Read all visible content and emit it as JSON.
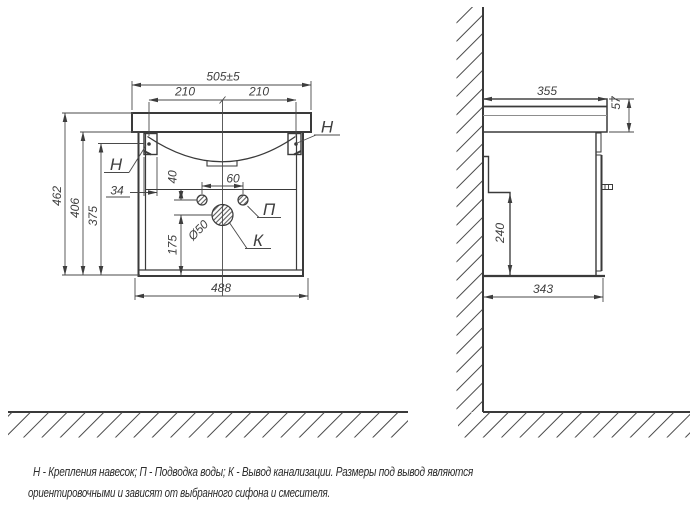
{
  "front_view": {
    "dims": {
      "top_width": "505±5",
      "hanger_span_left": "210",
      "hanger_span_right": "210",
      "height_total": "462",
      "height_body": "406",
      "height_hanger": "375",
      "hanger_offset": "34",
      "hole_drop": "40",
      "hole_span": "60",
      "drain_drop": "175",
      "drain_diameter": "Ø50",
      "bottom_width": "488"
    },
    "labels": {
      "hanger": "Н",
      "water": "П",
      "drain": "К"
    }
  },
  "side_view": {
    "dims": {
      "top_depth": "355",
      "top_height": "57",
      "back_panel_height": "240",
      "bottom_depth": "343"
    }
  },
  "caption": {
    "line1": "Н - Крепления навесок; П - Подводка воды; К - Вывод канализации. Размеры под вывод являются",
    "line2": "ориентировочными и зависят от выбранного сифона и смесителя."
  },
  "colors": {
    "line": "#3a3a3a",
    "dim": "#4a4a4a",
    "text": "#3f3f3f",
    "background": "#ffffff"
  }
}
